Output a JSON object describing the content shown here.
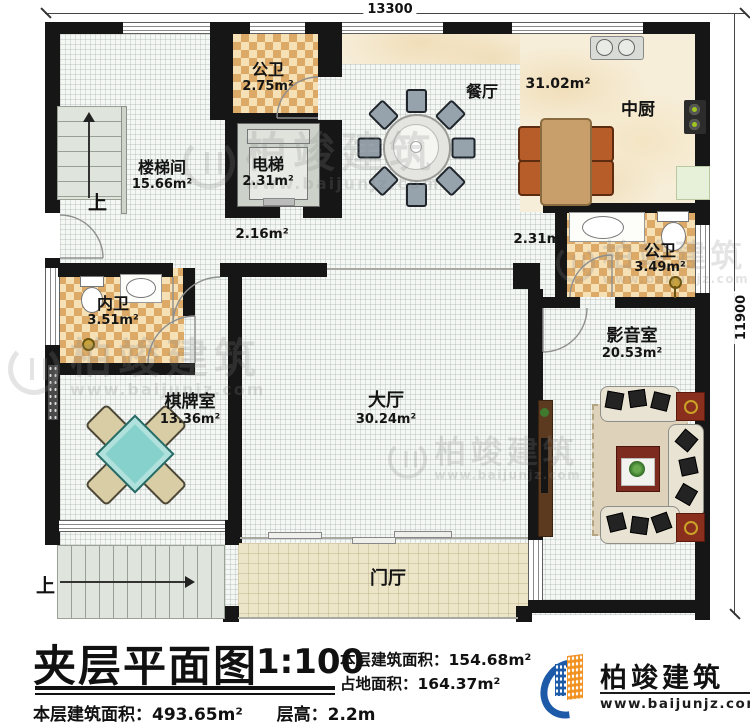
{
  "dimensions": {
    "top": "13300",
    "right": "11900"
  },
  "rooms": {
    "gongwei_top": {
      "name": "公卫",
      "area": "2.75m²"
    },
    "dianti": {
      "name": "电梯",
      "area": "2.31m²"
    },
    "loutijian": {
      "name": "楼梯间",
      "area": "15.66m²"
    },
    "canting": {
      "name": "餐厅",
      "area": "31.02m²"
    },
    "zhongchu": {
      "name": "中厨"
    },
    "gongwei_right": {
      "name": "公卫",
      "area": "3.49m²"
    },
    "neiwei": {
      "name": "内卫",
      "area": "3.51m²"
    },
    "yingyinshi": {
      "name": "影音室",
      "area": "20.53m²"
    },
    "qipaishi": {
      "name": "棋牌室",
      "area": "13.36m²"
    },
    "dating": {
      "name": "大厅",
      "area": "30.24m²"
    },
    "menting": {
      "name": "门厅"
    }
  },
  "corridor": {
    "left_area": "2.16m²",
    "right_area": "2.31m²"
  },
  "stairs": {
    "up_label": "上"
  },
  "titleblock": {
    "title": "夹层平面图",
    "scale": "1:100",
    "floor_area_label": "本层建筑面积：",
    "floor_area_value": "154.68m²",
    "site_area_label": "占地面积：",
    "site_area_value": "164.37m²",
    "total_area_label": "本层建筑面积：",
    "total_area_value": "493.65m²",
    "height_label": "层高：",
    "height_value": "2.2m"
  },
  "brand": {
    "name": "柏竣建筑",
    "website": "www.baijunjz.com"
  },
  "watermark": {
    "name": "柏竣建筑",
    "website": "www.baijunjz.com"
  }
}
